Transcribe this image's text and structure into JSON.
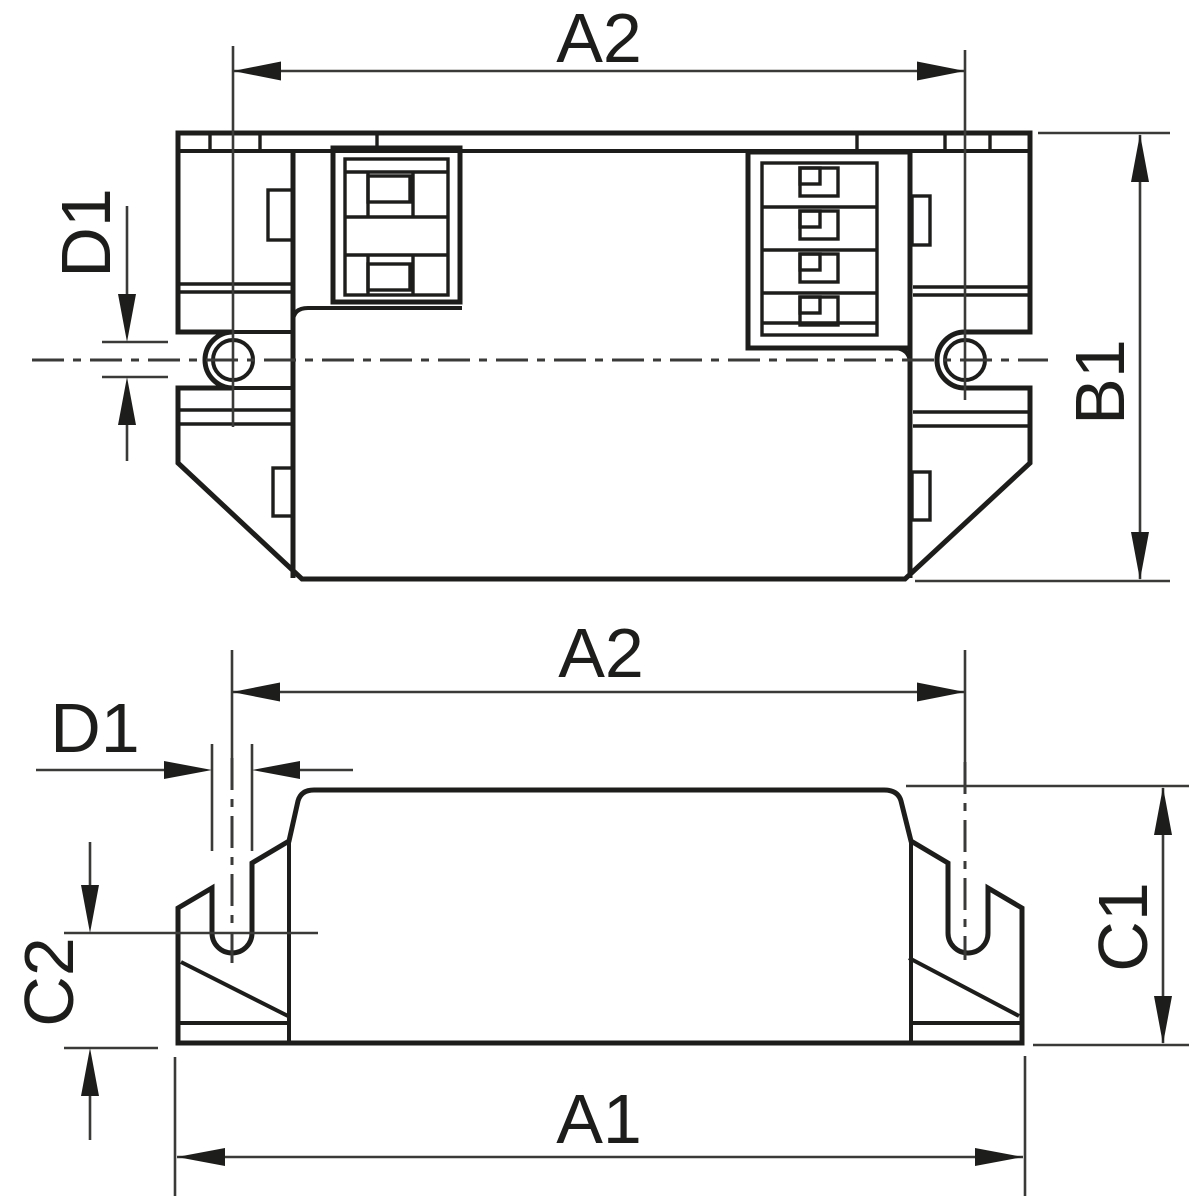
{
  "drawing": {
    "type": "technical-dimension-drawing",
    "colors": {
      "background": "#ffffff",
      "line": "#1d1d1b"
    },
    "views": {
      "top": {
        "labels": {
          "a2": "A2",
          "d1": "D1",
          "b1": "B1"
        }
      },
      "bottom": {
        "labels": {
          "a2": "A2",
          "d1": "D1",
          "c2": "C2",
          "c1": "C1",
          "a1": "A1"
        }
      }
    }
  }
}
